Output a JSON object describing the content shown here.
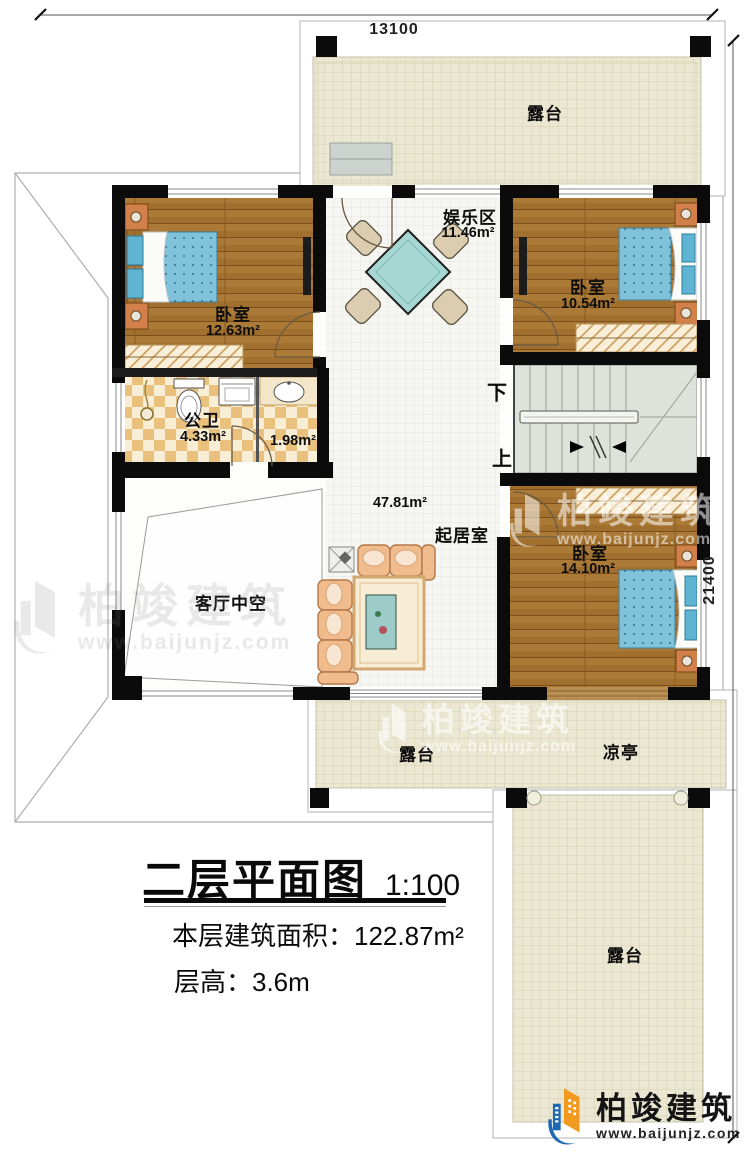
{
  "dimensions": {
    "width_label": "13100",
    "height_label": "21400"
  },
  "plan": {
    "terrace_top": "露台",
    "bedroom_left": {
      "name": "卧室",
      "area": "12.63m²"
    },
    "entertainment": {
      "name": "娱乐区",
      "area": "11.46m²"
    },
    "bedroom_right": {
      "name": "卧室",
      "area": "10.54m²"
    },
    "bathroom": {
      "name": "公卫",
      "area": "4.33m²"
    },
    "washroom": {
      "area": "1.98m²"
    },
    "living": {
      "name": "起居室",
      "area": "47.81m²"
    },
    "void": {
      "name": "客厅中空"
    },
    "bedroom_bottom": {
      "name": "卧室",
      "area": "14.10m²"
    },
    "terrace_bottom": "露台",
    "pavilion": "凉亭",
    "terrace_se": "露台",
    "stairs": {
      "down": "下",
      "up": "上"
    }
  },
  "title_block": {
    "title": "二层平面图",
    "scale": "1:100",
    "area_line": "本层建筑面积：122.87m²",
    "height_line": "层高：3.6m"
  },
  "brand": {
    "name": "柏竣建筑",
    "url": "www.baijunjz.com"
  },
  "colors": {
    "wall": "#0b0b0b",
    "wood": "#a2702e",
    "terrace_tile": "#ebe7d2",
    "checker": "#eac17c",
    "bed_blanket": "#7fc2da",
    "table": "#a6d7d2",
    "sofa": "#f0bc8e",
    "stairs": "#dde2da",
    "logo_blue": "#1e68b2",
    "logo_orange": "#f29a1f"
  }
}
